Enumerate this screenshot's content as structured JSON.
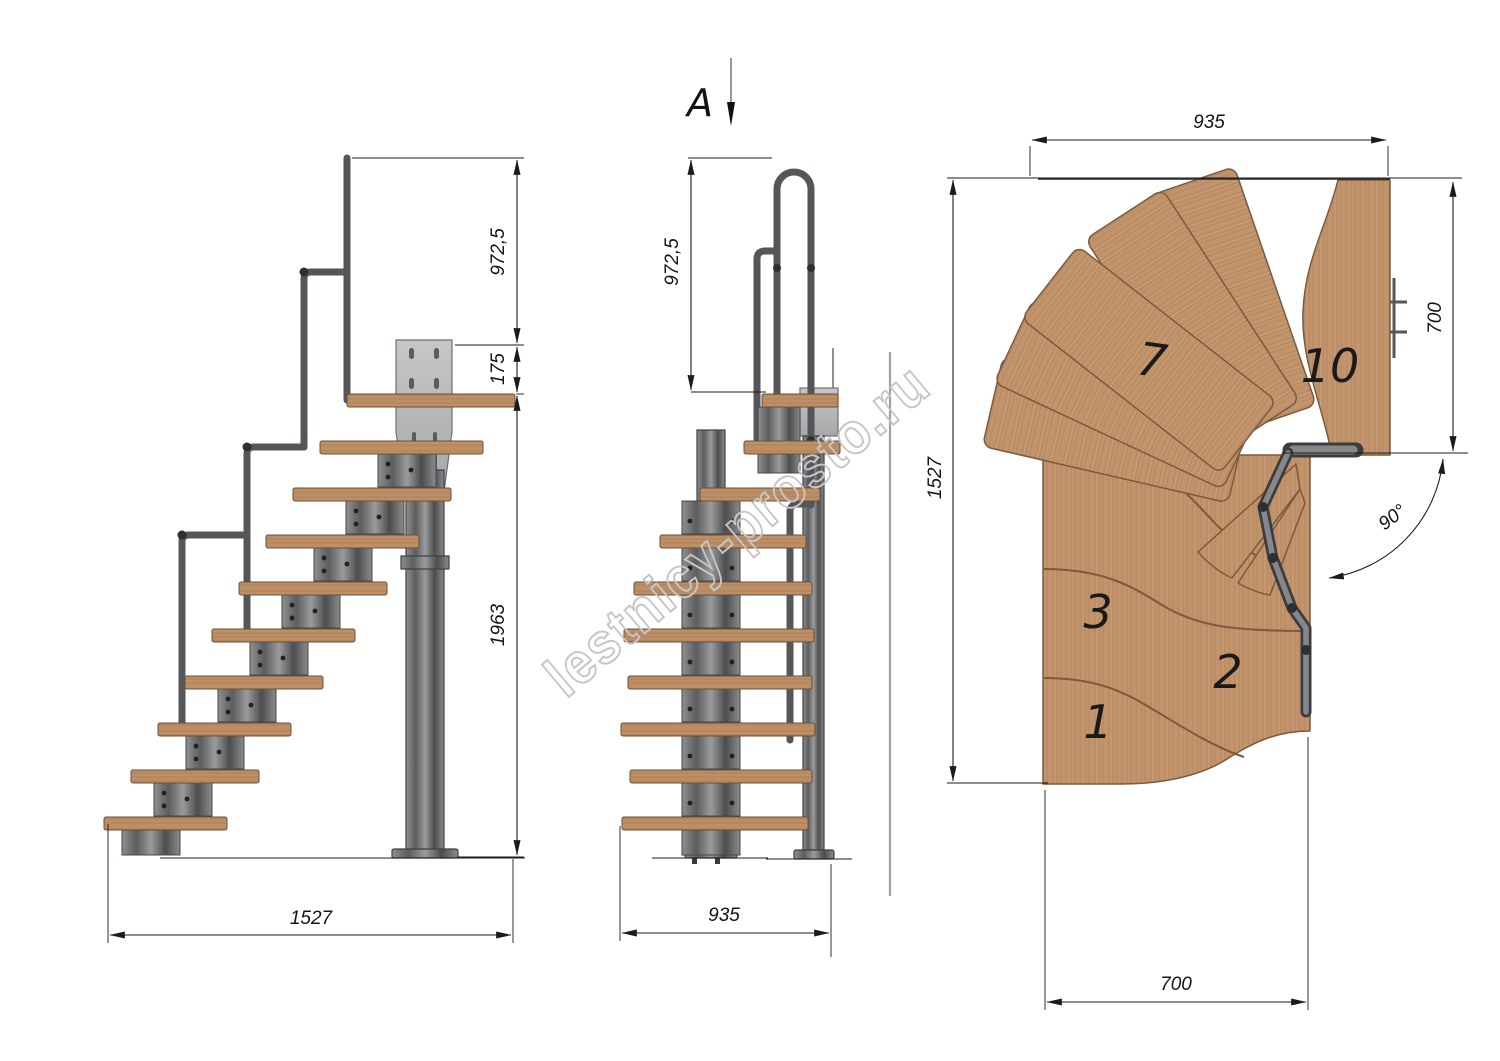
{
  "watermark_text": "lestnicy-prosto.ru",
  "section_marker": {
    "label": "A"
  },
  "side_view": {
    "dims": {
      "rail_height": "972,5",
      "plate_offset": "175",
      "stair_height": "1963",
      "stair_length": "1527"
    }
  },
  "front_view": {
    "dims": {
      "rail_height": "972,5",
      "stair_width": "935"
    }
  },
  "plan_view": {
    "dims": {
      "opening_width": "935",
      "landing_side": "700",
      "opening_length": "1527",
      "flight_width": "700",
      "turn_angle": "90°"
    },
    "tread_numbers": {
      "t1": "1",
      "t2": "2",
      "t3": "3",
      "t7": "7",
      "t10": "10"
    }
  },
  "colors": {
    "wood": "#c2946c",
    "wood_edge": "#7b5a3e",
    "metal": "#77787b",
    "metal_dark": "#3f4042",
    "plate": "#b7b8ba",
    "line": "#1b1b1b",
    "watermark": "#c6c6c6"
  }
}
